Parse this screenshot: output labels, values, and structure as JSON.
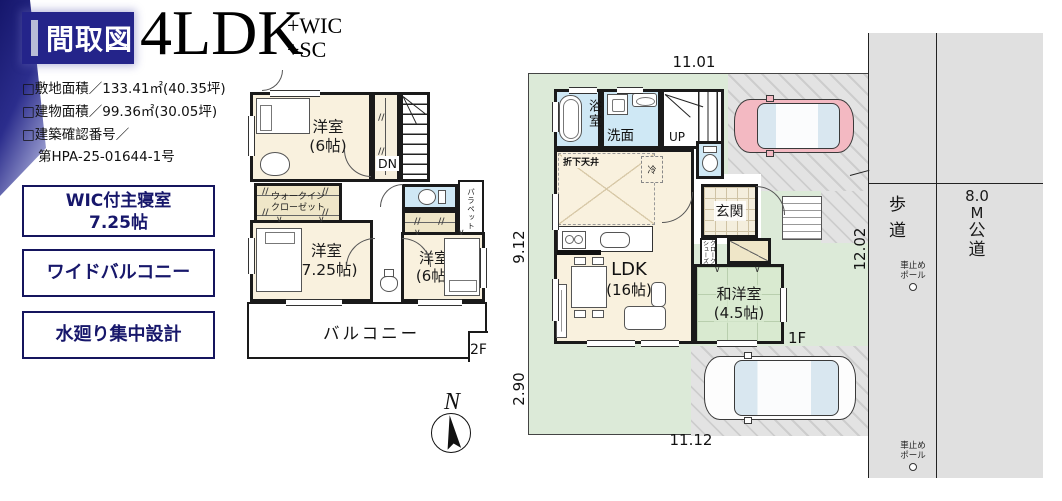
{
  "colors": {
    "navy": "#24248a",
    "room_cream": "#f9f1de",
    "room_blue": "#cfe8f5",
    "room_beige": "#efe6c8",
    "room_green": "#d9ead0",
    "site_green": "#dcead8",
    "road_gray": "#e0e0e0",
    "car_pink": "#f3b9c2",
    "wall": "#1a1a1a"
  },
  "header": {
    "badge": "間取図",
    "plan": "4LDK",
    "suffix1": "+WIC",
    "suffix2": "+SC",
    "info1": "□敷地面積／133.41㎡(40.35坪)",
    "info2": "□建物面積／99.36㎡(30.05坪)",
    "info3": "□建築確認番号／",
    "info4": "第HPA-25-01644-1号"
  },
  "features": {
    "f1a": "WIC付主寝室",
    "f1b": "7.25帖",
    "f2": "ワイドバルコニー",
    "f3": "水廻り集中設計"
  },
  "compass": {
    "n": "N"
  },
  "f2f": {
    "tag": "2F",
    "bed1a": "洋室",
    "bed1b": "(6帖)",
    "wica": "ウォークイン",
    "wicb": "クローゼット",
    "bed2a": "洋室",
    "bed2b": "(7.25帖)",
    "bed3a": "洋室",
    "bed3b": "(6帖)",
    "dn": "DN",
    "parapet": "パラペット",
    "balcony": "バルコニー"
  },
  "f1f": {
    "tag": "1F",
    "bath": "浴室",
    "wash": "洗面",
    "up": "UP",
    "oriage": "折下天井",
    "fridge": "冷",
    "genkan": "玄関",
    "shoesa": "シューズ",
    "shoesb": "クローク",
    "ldka": "LDK",
    "ldkb": "(16帖)",
    "wayoa": "和洋室",
    "wayob": "(4.5帖)"
  },
  "site": {
    "dim_top": "11.01",
    "dim_left_up": "9.12",
    "dim_left_low": "2.90",
    "dim_bottom": "11.12",
    "dim_right": "12.02",
    "sidewalk": "歩道",
    "road1": "8.0",
    "road2": "M",
    "road3": "公",
    "road4": "道",
    "polea": "車止め",
    "poleb": "ポール"
  },
  "sym": {
    "v": "∨",
    "pp": "//"
  }
}
